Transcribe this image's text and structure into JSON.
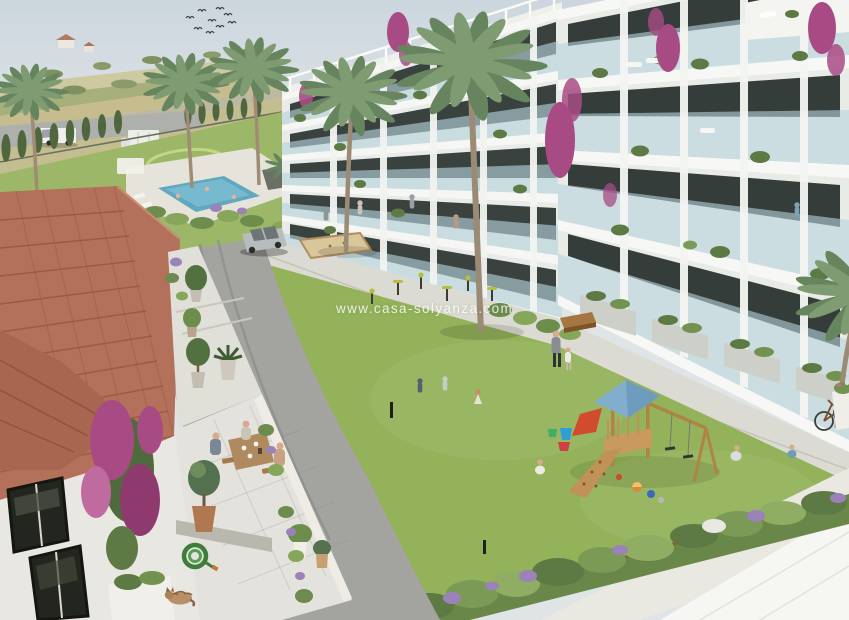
{
  "watermark": {
    "text": "www.casa-solyanza.com"
  },
  "scene": {
    "setting": "aerial architectural rendering of a Mediterranean residential resort complex",
    "colors": {
      "sky_top": "#ccd6de",
      "sky_bottom": "#eef0ee",
      "lawn": "#93b25a",
      "resort_lawn": "#9cb768",
      "field_wheat": "#c7bc8e",
      "field_green": "#a7b07c",
      "building_white": "#eef0ec",
      "slab_white": "#f6f7f4",
      "wall_light": "#e8ebe7",
      "window_dark": "#3a423f",
      "balcony_glass": "#b7d3dc",
      "roof_tiles": "#b3705a",
      "pool_water": "#5fa8c0",
      "pool_deck": "#e6e4da",
      "asphalt": "#a3a49f",
      "concrete": "#dcdbd3",
      "terrace_marble": "#e3e2dc",
      "playground_wood": "#c89a5e",
      "playground_roof": "#82aecd",
      "slide_red": "#d14b2e",
      "bougainvillea": "#a84b85",
      "cypress": "#50663f",
      "palm_green": "#7e9b72",
      "palm_shadow": "#66855f",
      "shrub_green": "#6a874a",
      "lavender": "#9b82b8",
      "petanque_sand": "#d9c69b",
      "suv_silver": "#b9bcbc",
      "car_red": "#b8352c",
      "van_white": "#f0f1ec"
    },
    "objects": [
      "apartment-buildings",
      "glass-balconies",
      "rooftop-pergolas",
      "swimming-pool",
      "sun-loungers",
      "central-lawn",
      "wood-playground",
      "swing-set",
      "red-slide",
      "toy-buckets",
      "balls",
      "outdoor-gym",
      "petanque-court",
      "tiled-roof-house",
      "terrace-dining-table",
      "potted-olive-trees",
      "garden-hose",
      "sleeping-cat",
      "parked-suv",
      "delivery-vans",
      "red-car",
      "palm-trees",
      "cypress-hedge",
      "bougainvillea-vines",
      "lavender-shrubs",
      "bicycle",
      "flying-birds",
      "residents-walking",
      "children-playing",
      "swimmers"
    ]
  }
}
